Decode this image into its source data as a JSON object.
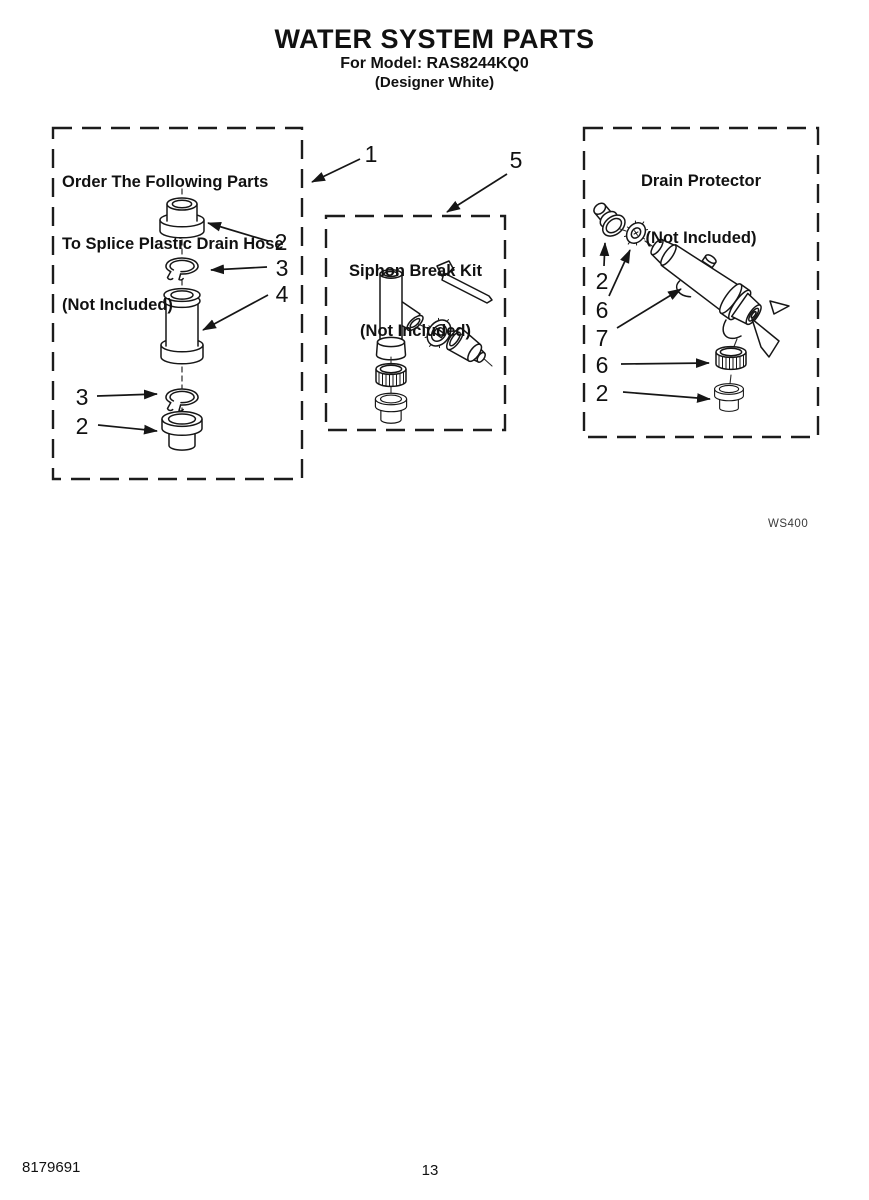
{
  "page": {
    "title": "WATER SYSTEM PARTS",
    "model_line": "For Model: RAS8244KQ0",
    "finish_line": "(Designer White)",
    "diagram_code": "WS400",
    "doc_number": "8179691",
    "page_number": "13"
  },
  "boxes": {
    "splice": {
      "title_lines": [
        "Order The Following Parts",
        "To Splice Plastic Drain Hose",
        "(Not Included)"
      ]
    },
    "siphon": {
      "title_lines": [
        "Siphon Break Kit",
        "(Not Included)"
      ]
    },
    "drain": {
      "title_lines": [
        "Drain Protector",
        "(Not Included)"
      ]
    }
  },
  "callouts": {
    "splice_box_ref": "1",
    "siphon_box_ref": "5",
    "splice_parts": [
      "2",
      "3",
      "4",
      "3",
      "2"
    ],
    "drain_parts": [
      "2",
      "6",
      "7",
      "6",
      "2"
    ]
  },
  "colors": {
    "ink": "#161616",
    "paper": "#ffffff"
  }
}
